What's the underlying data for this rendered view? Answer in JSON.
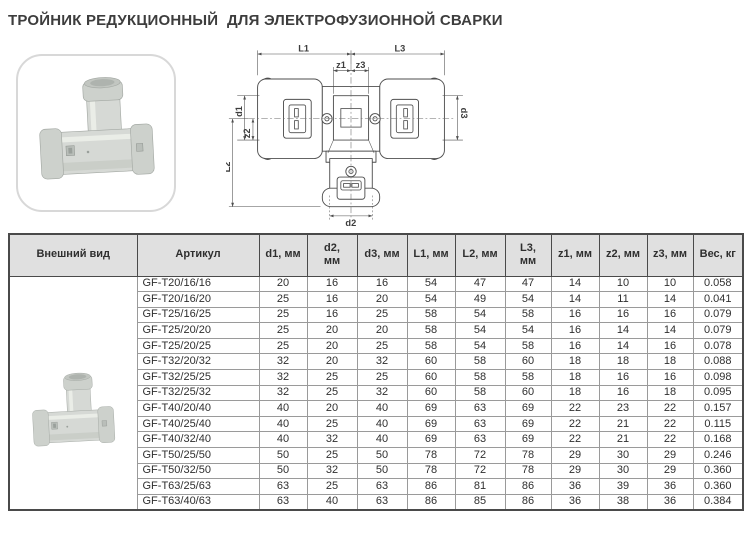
{
  "page": {
    "title": "ТРОЙНИК РЕДУКЦИОННЫЙ  ДЛЯ ЭЛЕКТРОФУЗИОННОЙ СВАРКИ"
  },
  "colors": {
    "page_bg": "#ffffff",
    "title_text": "#3d3d3d",
    "table_header_bg": "#e0e0e0",
    "table_border_dark": "#4a4a4a",
    "table_border_light": "#9a9a9a",
    "table_text": "#2f2f2f",
    "drawing_stroke": "#4e4e4e",
    "photo_card_border": "#d8d8d8",
    "product_body": "#d6d9d5",
    "product_stroke": "#a3a8a3"
  },
  "images": {
    "main_photo": "tee-fitting-photo",
    "table_thumbnail": "tee-fitting-thumbnail"
  },
  "diagram": {
    "labels": {
      "L1": "L1",
      "L3": "L3",
      "z1": "z1",
      "z3": "z3",
      "d1": "d1",
      "z2": "z2",
      "L2": "L2",
      "d3": "d3",
      "d2": "d2"
    }
  },
  "table": {
    "headers": [
      "Внешний вид",
      "Артикул",
      "d1, мм",
      "d2,\nмм",
      "d3, мм",
      "L1, мм",
      "L2, мм",
      "L3,\nмм",
      "z1, мм",
      "z2, мм",
      "z3, мм",
      "Вес, кг"
    ],
    "rows": [
      {
        "article": "GF-T20/16/16",
        "values": [
          "20",
          "16",
          "16",
          "54",
          "47",
          "47",
          "14",
          "10",
          "10",
          "0.058"
        ]
      },
      {
        "article": "GF-T20/16/20",
        "values": [
          "25",
          "16",
          "20",
          "54",
          "49",
          "54",
          "14",
          "11",
          "14",
          "0.041"
        ]
      },
      {
        "article": "GF-T25/16/25",
        "values": [
          "25",
          "16",
          "25",
          "58",
          "54",
          "58",
          "16",
          "16",
          "16",
          "0.079"
        ]
      },
      {
        "article": "GF-T25/20/20",
        "values": [
          "25",
          "20",
          "20",
          "58",
          "54",
          "54",
          "16",
          "14",
          "14",
          "0.079"
        ]
      },
      {
        "article": "GF-T25/20/25",
        "values": [
          "25",
          "20",
          "25",
          "58",
          "54",
          "58",
          "16",
          "14",
          "16",
          "0.078"
        ]
      },
      {
        "article": "GF-T32/20/32",
        "values": [
          "32",
          "20",
          "32",
          "60",
          "58",
          "60",
          "18",
          "18",
          "18",
          "0.088"
        ]
      },
      {
        "article": "GF-T32/25/25",
        "values": [
          "32",
          "25",
          "25",
          "60",
          "58",
          "58",
          "18",
          "16",
          "16",
          "0.098"
        ]
      },
      {
        "article": "GF-T32/25/32",
        "values": [
          "32",
          "25",
          "32",
          "60",
          "58",
          "60",
          "18",
          "16",
          "18",
          "0.095"
        ]
      },
      {
        "article": "GF-T40/20/40",
        "values": [
          "40",
          "20",
          "40",
          "69",
          "63",
          "69",
          "22",
          "23",
          "22",
          "0.157"
        ]
      },
      {
        "article": "GF-T40/25/40",
        "values": [
          "40",
          "25",
          "40",
          "69",
          "63",
          "69",
          "22",
          "21",
          "22",
          "0.115"
        ]
      },
      {
        "article": "GF-T40/32/40",
        "values": [
          "40",
          "32",
          "40",
          "69",
          "63",
          "69",
          "22",
          "21",
          "22",
          "0.168"
        ]
      },
      {
        "article": "GF-T50/25/50",
        "values": [
          "50",
          "25",
          "50",
          "78",
          "72",
          "78",
          "29",
          "30",
          "29",
          "0.246"
        ]
      },
      {
        "article": "GF-T50/32/50",
        "values": [
          "50",
          "32",
          "50",
          "78",
          "72",
          "78",
          "29",
          "30",
          "29",
          "0.360"
        ]
      },
      {
        "article": "GF-T63/25/63",
        "values": [
          "63",
          "25",
          "63",
          "86",
          "81",
          "86",
          "36",
          "39",
          "36",
          "0.360"
        ]
      },
      {
        "article": "GF-T63/40/63",
        "values": [
          "63",
          "40",
          "63",
          "86",
          "85",
          "86",
          "36",
          "38",
          "36",
          "0.384"
        ]
      }
    ]
  }
}
